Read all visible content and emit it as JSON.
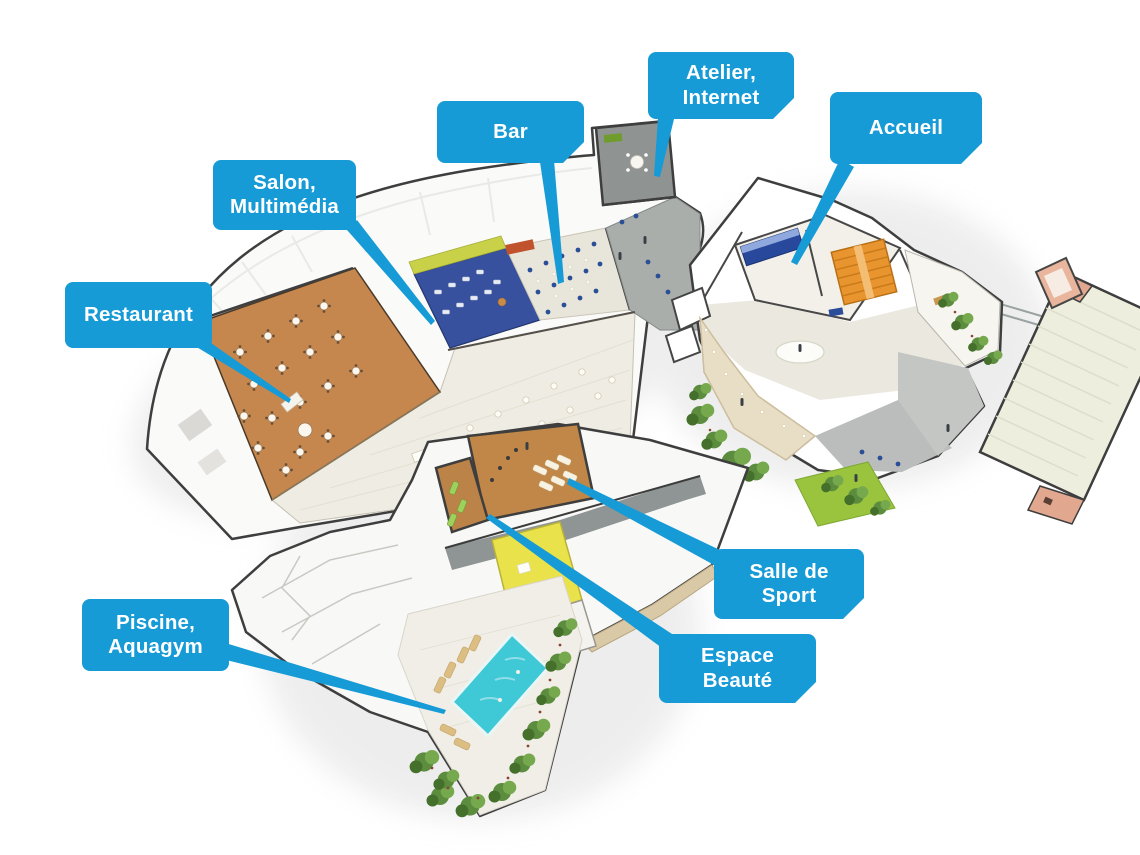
{
  "figure": {
    "kind": "hotel-facilities-cutaway-floor-plan",
    "language": "fr"
  },
  "colors": {
    "label_background": "#179bd6",
    "label_text": "#ffffff",
    "pool_water": "#3fc8d6",
    "restaurant_floor": "#c6874f",
    "salon_carpet": "#37519f",
    "gym_floor": "#c08748",
    "lime_wall": "#c9d148",
    "yellow_room": "#e9e24a",
    "wall_cutaway": "#3e3e3e",
    "roof_white": "#fafaf9",
    "lawn_green": "#9ac43e"
  },
  "labels": [
    {
      "id": "restaurant",
      "lines": [
        "Restaurant"
      ],
      "points_to": "dining room with tables"
    },
    {
      "id": "salon",
      "lines": [
        "Salon,",
        "Multimédia"
      ],
      "points_to": "blue-carpet lounge"
    },
    {
      "id": "bar",
      "lines": [
        "Bar"
      ],
      "points_to": "bar seating area"
    },
    {
      "id": "atelier",
      "lines": [
        "Atelier,",
        "Internet"
      ],
      "points_to": "small workshop room"
    },
    {
      "id": "accueil",
      "lines": [
        "Accueil"
      ],
      "points_to": "reception desk"
    },
    {
      "id": "salle-de-sport",
      "lines": [
        "Salle de",
        "Sport"
      ],
      "points_to": "gym with mats"
    },
    {
      "id": "espace-beaute",
      "lines": [
        "Espace",
        "Beauté"
      ],
      "points_to": "beauty room with loungers"
    },
    {
      "id": "piscine",
      "lines": [
        "Piscine,",
        "Aquagym"
      ],
      "points_to": "outdoor pool"
    }
  ]
}
